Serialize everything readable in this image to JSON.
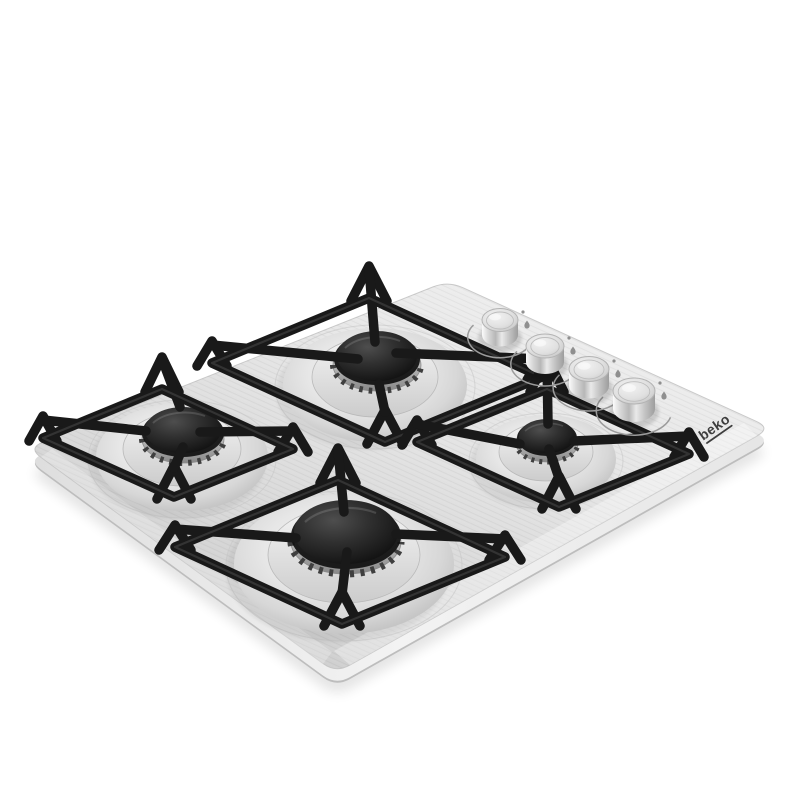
{
  "image": {
    "kind": "product-photo",
    "background_color": "#ffffff",
    "description": "Angled studio photograph of a Beko stainless steel 4-burner gas hob with black pan supports and four round stainless control knobs on a white background"
  },
  "brand": {
    "logo_text": "beko",
    "logo_color": "#3d3d3d"
  },
  "hob": {
    "surface_finish": "brushed stainless steel",
    "surface_color": "#e3e3e3",
    "edge_color": "#c7c7c7",
    "pan_support_color": "#1a1a1a",
    "burner_cap_color": "#262626",
    "knob_finish_color": "#d6d6d6",
    "knob_count": 4,
    "burners": [
      {
        "position": "back-center",
        "size": "medium"
      },
      {
        "position": "left-center",
        "size": "medium"
      },
      {
        "position": "right-center",
        "size": "auxiliary"
      },
      {
        "position": "front-center",
        "size": "large"
      }
    ],
    "knob_markings": [
      "rotation-arc",
      "flame-low-dot",
      "flame-high-icon"
    ]
  }
}
